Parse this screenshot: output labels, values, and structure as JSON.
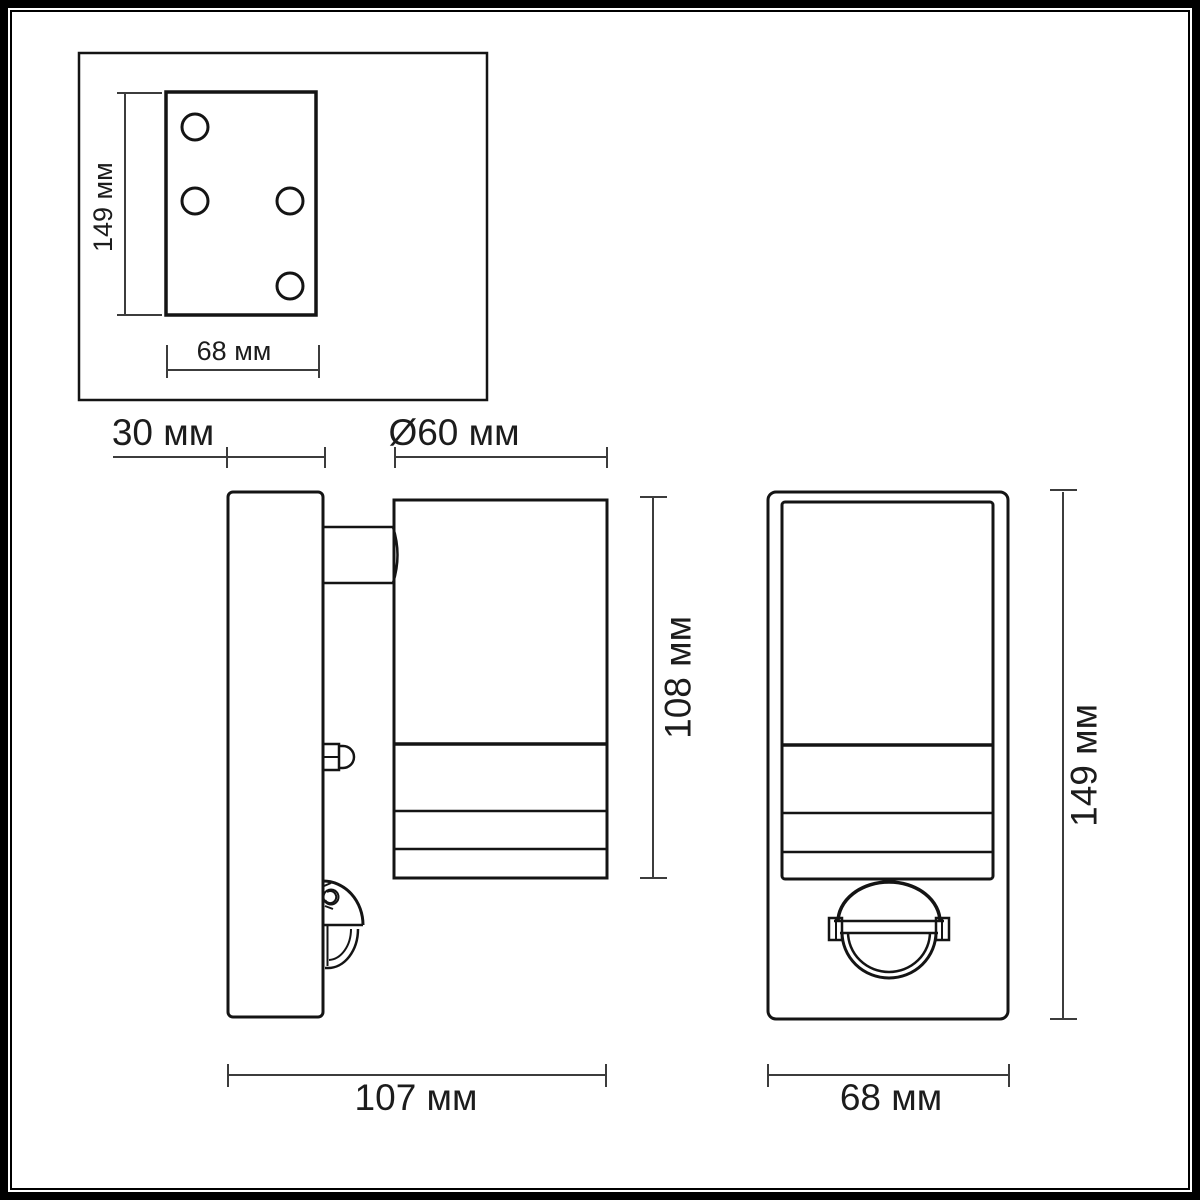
{
  "meta": {
    "title": "Luminaire dimension drawing",
    "unit": "мм"
  },
  "palette": {
    "background": "#ffffff",
    "frame": "#000000",
    "object_line": "#141414",
    "dimension_line": "#3c3c3c",
    "text": "#1c1c1c"
  },
  "views": {
    "plate_front": {
      "height_label": "149 мм",
      "width_label": "68 мм"
    },
    "side": {
      "plate_depth_label": "30 мм",
      "diameter_label": "Ø60 мм",
      "body_height_label": "108 мм",
      "total_depth_label": "107 мм"
    },
    "front": {
      "height_label": "149 мм",
      "width_label": "68 мм"
    }
  },
  "dimensions_mm": {
    "plate_height": 149,
    "plate_width": 68,
    "plate_depth": 30,
    "lamp_diameter": 60,
    "lamp_body_height": 108,
    "total_depth": 107,
    "front_height": 149,
    "front_width": 68
  }
}
